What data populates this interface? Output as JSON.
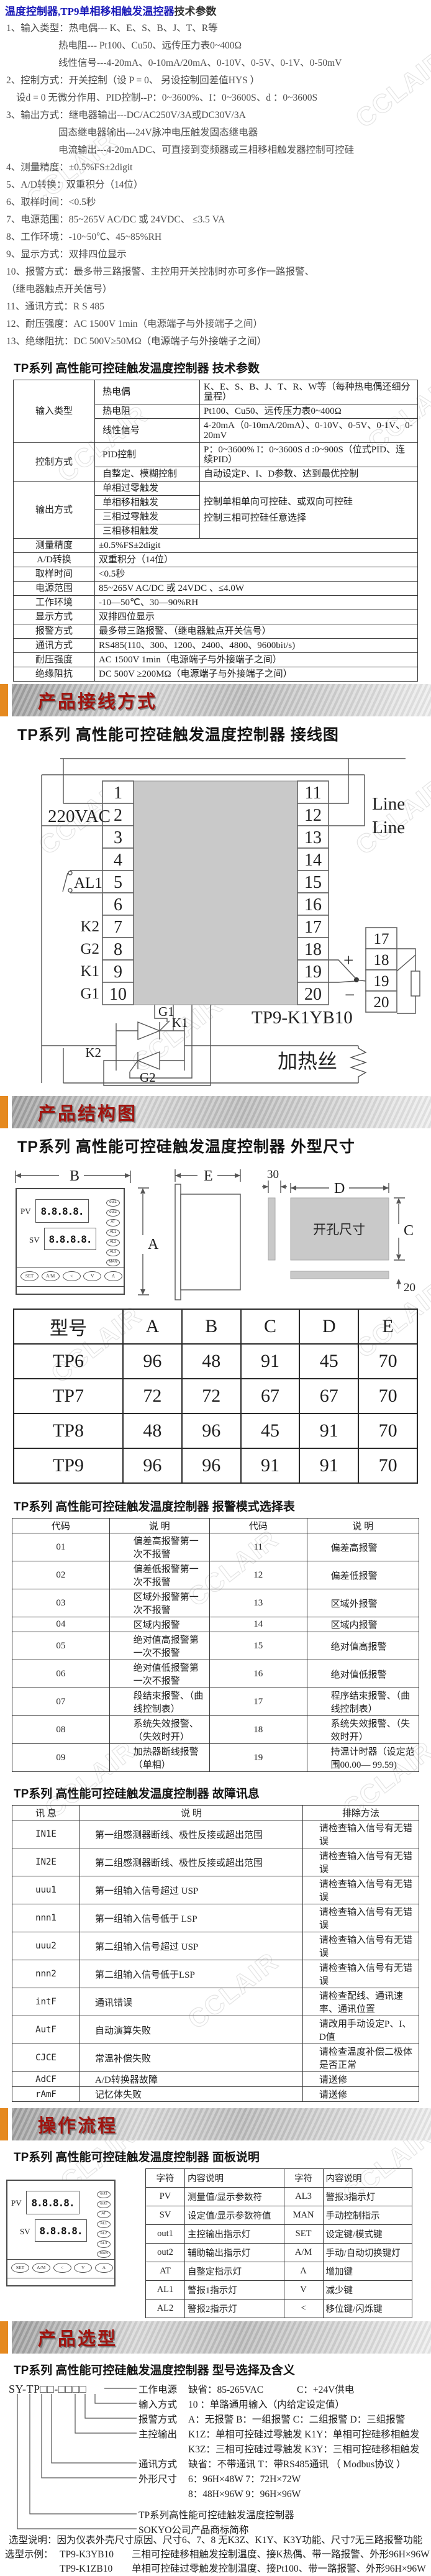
{
  "watermark": "CCLAIR",
  "intro": {
    "title_blue": "温度控制器,TP9单相移相触发温控器",
    "title_black": "技术参数",
    "lines": [
      {
        "indent": 0,
        "text": "1、输入类型：热电偶--- K、E、S、B、J、T、R等"
      },
      {
        "indent": 1,
        "text": "热电阻--- Pt100、Cu50、远传压力表0~400Ω"
      },
      {
        "indent": 1,
        "text": "线性信号---4-20mA、0-10mA/20mA、0-10V、0-5V、0-1V、0-50mV"
      },
      {
        "indent": 0,
        "text": "2、控制方式：开关控制（设 P = 0、 另设控制回差值HYS ）"
      },
      {
        "indent": 2,
        "text": "设d = 0  无微分作用、PID控制--P：0~3600%、I：0~3600S、d ：0~3600S"
      },
      {
        "indent": 0,
        "text": "3、输出方式：继电器输出---DC/AC250V/3A或DC30V/3A"
      },
      {
        "indent": 1,
        "text": "固态继电器输出---24V脉冲电压触发固态继电器"
      },
      {
        "indent": 1,
        "text": "电流输出---4-20mADC、可直接到变频器或三相移相触发器控制可控硅"
      },
      {
        "indent": 0,
        "text": "4、测量精度：±0.5%FS±2digit"
      },
      {
        "indent": 0,
        "text": "5、A/D转换：双重积分（14位）"
      },
      {
        "indent": 0,
        "text": "6、取样时间：<0.5秒"
      },
      {
        "indent": 0,
        "text": "7、电源范围：85~265V  AC/DC 或  24VDC、  ≤3.5 VA"
      },
      {
        "indent": 0,
        "text": "8、工作环境：-10~50℃、45~85%RH"
      },
      {
        "indent": 0,
        "text": "9、显示方式：双排四位显示"
      },
      {
        "indent": 0,
        "text": "10、报警方式：最多带三路报警、主控用开关控制时亦可多作一路报警、"
      },
      {
        "indent": 0,
        "text": "（继电器触点开关信号）"
      },
      {
        "indent": 0,
        "text": "11、通讯方式：R S 485"
      },
      {
        "indent": 0,
        "text": "12、耐压强度：AC 1500V 1min（电源端子与外接端子之间）"
      },
      {
        "indent": 0,
        "text": "13、绝缘阻抗：DC  500V≥50MΩ（电源端子与外接端子之间）"
      }
    ]
  },
  "spec": {
    "title": "TP系列 高性能可控硅触发温度控制器 技术参数",
    "rows": [
      [
        {
          "t": "输入类型",
          "rs": 3,
          "cls": "c1"
        },
        {
          "t": "热电偶",
          "cls": "c2"
        },
        {
          "t": "K、E、S、B、J、T、R、W等（每种热电偶还细分量程）"
        }
      ],
      [
        {
          "t": "热电阻",
          "cls": "c2"
        },
        {
          "t": "Pt100、Cu50、远传压力表0~400Ω"
        }
      ],
      [
        {
          "t": "线性信号",
          "cls": "c2"
        },
        {
          "t": "4-20mA（0-10mA/20mA）、0-10V、0-5V、0-1V、0-20mV"
        }
      ],
      [
        {
          "t": "控制方式",
          "rs": 2,
          "cls": "c1"
        },
        {
          "t": "PID控制",
          "cls": "c2"
        },
        {
          "t": "P：0~3600%  I：0~3600S d :0~900S（位式PID、连续PID）"
        }
      ],
      [
        {
          "t": "自整定、模糊控制",
          "cls": "c2"
        },
        {
          "t": "自动设定P、I、D参数、达到最优控制"
        }
      ],
      [
        {
          "t": "输出方式",
          "rs": 4,
          "cls": "c1"
        },
        {
          "t": "单相过零触发",
          "cls": "c2"
        },
        {
          "t": "控制单相单向可控硅、或双向可控硅\n控制三相可控硅任意选择",
          "rs": 4,
          "cls": "pre"
        }
      ],
      [
        {
          "t": "单相移相触发",
          "cls": "c2"
        }
      ],
      [
        {
          "t": "三相过零触发",
          "cls": "c2"
        }
      ],
      [
        {
          "t": "三相移相触发",
          "cls": "c2"
        }
      ],
      [
        {
          "t": "测量精度",
          "cls": "c1"
        },
        {
          "t": "±0.5%FS±2digit",
          "cs": 2
        }
      ],
      [
        {
          "t": "A/D转换",
          "cls": "c1"
        },
        {
          "t": "双重积分（14位）",
          "cs": 2
        }
      ],
      [
        {
          "t": "取样时间",
          "cls": "c1"
        },
        {
          "t": "<0.5秒",
          "cs": 2
        }
      ],
      [
        {
          "t": "电源范围",
          "cls": "c1"
        },
        {
          "t": "85~265V  AC/DC 或 24VDC 、≤4.0W",
          "cs": 2
        }
      ],
      [
        {
          "t": "工作环境",
          "cls": "c1"
        },
        {
          "t": "-10—50℃、30—90%RH",
          "cs": 2
        }
      ],
      [
        {
          "t": "显示方式",
          "cls": "c1"
        },
        {
          "t": "双排四位显示",
          "cs": 2
        }
      ],
      [
        {
          "t": "报警方式",
          "cls": "c1"
        },
        {
          "t": "最多带三路报警、（继电器触点开关信号）",
          "cs": 2
        }
      ],
      [
        {
          "t": "通讯方式",
          "cls": "c1"
        },
        {
          "t": "RS485(110、300、1200、2400、4800、9600bit/s)",
          "cs": 2
        }
      ],
      [
        {
          "t": "耐压强度",
          "cls": "c1"
        },
        {
          "t": "AC 1500V  1min（电源端子与外接端子之间）",
          "cs": 2
        }
      ],
      [
        {
          "t": "绝缘阻抗",
          "cls": "c1"
        },
        {
          "t": "DC 500V  ≥200MΩ（电源端子与外接端子之间）",
          "cs": 2
        }
      ]
    ]
  },
  "banners": {
    "wiring": "产品接线方式",
    "structure": "产品结构图",
    "operation": "操作流程",
    "selection": "产品选型"
  },
  "wiring": {
    "title": "TP系列 高性能可控硅触发温度控制器 接线图",
    "voltage": "220VAC",
    "al1": "AL1",
    "k2": "K2",
    "g2": "G2",
    "k1": "K1",
    "g1": "G1",
    "line1": "Line",
    "line2": "Line",
    "plus": "+",
    "minus": "−",
    "g1_scr": "G1",
    "k1_scr": "K1",
    "k2_scr": "K2",
    "g2_scr": "G2",
    "model": "TP9-K1YB10",
    "heater": "加热丝",
    "left_terminals": [
      "1",
      "2",
      "3",
      "4",
      "5",
      "6",
      "7",
      "8",
      "9",
      "10"
    ],
    "right_terminals": [
      "11",
      "12",
      "13",
      "14",
      "15",
      "16",
      "17",
      "18",
      "19",
      "20"
    ],
    "sensor_terminals": [
      "17",
      "18",
      "19",
      "20"
    ]
  },
  "structure": {
    "title": "TP系列 高性能可控硅触发温度控制器 外型尺寸",
    "dims": {
      "A": "A",
      "B": "B",
      "C": "C",
      "D": "D",
      "E": "E",
      "d30": "30",
      "d20": "20",
      "cutout": "开孔尺寸"
    }
  },
  "panel": {
    "pv": "PV",
    "sv": "SV",
    "digits": "8.8.8.8.",
    "indicators": [
      "out1",
      "out2",
      "AT",
      "AL1",
      "AL2",
      "AL3",
      "MAN"
    ],
    "buttons": [
      "SET",
      "A/M",
      "<",
      "V",
      "Λ"
    ]
  },
  "dim_table": {
    "rows": [
      [
        "型号",
        "A",
        "B",
        "C",
        "D",
        "E"
      ],
      [
        "TP6",
        "96",
        "48",
        "91",
        "45",
        "70"
      ],
      [
        "TP7",
        "72",
        "72",
        "67",
        "67",
        "70"
      ],
      [
        "TP8",
        "48",
        "96",
        "45",
        "91",
        "70"
      ],
      [
        "TP9",
        "96",
        "96",
        "91",
        "91",
        "70"
      ]
    ]
  },
  "alarm": {
    "title": "TP系列 高性能可控硅触发温度控制器 报警模式选择表",
    "rows": [
      [
        {
          "t": "代码",
          "cls": "ctr"
        },
        {
          "t": "说    明",
          "cls": "ctr"
        },
        {
          "t": "代码",
          "cls": "ctr"
        },
        {
          "t": "说    明",
          "cls": "ctr"
        }
      ],
      [
        {
          "t": "01",
          "cls": "ctr"
        },
        {
          "t": "偏差高报警第一次不报警",
          "cls": "dsc"
        },
        {
          "t": "11",
          "cls": "ctr"
        },
        {
          "t": "偏差高报警",
          "cls": "dsc"
        }
      ],
      [
        {
          "t": "02",
          "cls": "ctr"
        },
        {
          "t": "偏差低报警第一次不报警",
          "cls": "dsc"
        },
        {
          "t": "12",
          "cls": "ctr"
        },
        {
          "t": "偏差低报警",
          "cls": "dsc"
        }
      ],
      [
        {
          "t": "03",
          "cls": "ctr"
        },
        {
          "t": "区域外报警第一次不报警",
          "cls": "dsc"
        },
        {
          "t": "13",
          "cls": "ctr"
        },
        {
          "t": "区域外报警",
          "cls": "dsc"
        }
      ],
      [
        {
          "t": "04",
          "cls": "ctr"
        },
        {
          "t": "区域内报警",
          "cls": "dsc"
        },
        {
          "t": "14",
          "cls": "ctr"
        },
        {
          "t": "区域内报警",
          "cls": "dsc"
        }
      ],
      [
        {
          "t": "05",
          "cls": "ctr"
        },
        {
          "t": "绝对值高报警第一次不报警",
          "cls": "dsc"
        },
        {
          "t": "15",
          "cls": "ctr"
        },
        {
          "t": "绝对值高报警",
          "cls": "dsc"
        }
      ],
      [
        {
          "t": "06",
          "cls": "ctr"
        },
        {
          "t": "绝对值低报警第一次不报警",
          "cls": "dsc"
        },
        {
          "t": "16",
          "cls": "ctr"
        },
        {
          "t": "绝对值低报警",
          "cls": "dsc"
        }
      ],
      [
        {
          "t": "07",
          "cls": "ctr"
        },
        {
          "t": "段结束报警、（曲线控制表）",
          "cls": "dsc"
        },
        {
          "t": "17",
          "cls": "ctr"
        },
        {
          "t": "程序结束报警、（曲线控制表）",
          "cls": "dsc"
        }
      ],
      [
        {
          "t": "08",
          "cls": "ctr"
        },
        {
          "t": "系统失效报警、（失效时开）",
          "cls": "dsc"
        },
        {
          "t": "18",
          "cls": "ctr"
        },
        {
          "t": "系统失效报警、（失效时开）",
          "cls": "dsc"
        }
      ],
      [
        {
          "t": "09",
          "cls": "ctr"
        },
        {
          "t": "加热器断线报警（单相）",
          "cls": "dsc"
        },
        {
          "t": "19",
          "cls": "ctr"
        },
        {
          "t": "持温计时器（设定范围00.00— 99.59)",
          "cls": "dsc"
        }
      ]
    ]
  },
  "fault": {
    "title": "TP系列 高性能可控硅触发温度控制器 故障讯息",
    "rows": [
      [
        {
          "t": "讯  息",
          "cls": "ctr"
        },
        {
          "t": "说  明",
          "cls": "ctr"
        },
        {
          "t": "排除方法",
          "cls": "ctr"
        }
      ],
      [
        {
          "t": "IN1E",
          "cls": "code"
        },
        {
          "t": "第一组感测器断线、极性反接或超出范围",
          "cls": "dsc"
        },
        {
          "t": "请检查输入信号有无错误",
          "cls": "dsc2"
        }
      ],
      [
        {
          "t": "IN2E",
          "cls": "code"
        },
        {
          "t": "第二组感测器断线、极性反接或超出范围",
          "cls": "dsc"
        },
        {
          "t": "请检查输入信号有无错误",
          "cls": "dsc2"
        }
      ],
      [
        {
          "t": "uuu1",
          "cls": "code"
        },
        {
          "t": "第一组输入信号超过 USP",
          "cls": "dsc"
        },
        {
          "t": "请检查输入信号有无错误",
          "cls": "dsc2"
        }
      ],
      [
        {
          "t": "nnn1",
          "cls": "code"
        },
        {
          "t": "第一组输入信号低于 LSP",
          "cls": "dsc"
        },
        {
          "t": "请检查输入信号有无错误",
          "cls": "dsc2"
        }
      ],
      [
        {
          "t": "uuu2",
          "cls": "code"
        },
        {
          "t": "第二组输入信号超过 USP",
          "cls": "dsc"
        },
        {
          "t": "请检查输入信号有无错误",
          "cls": "dsc2"
        }
      ],
      [
        {
          "t": "nnn2",
          "cls": "code"
        },
        {
          "t": "第二组输入信号低于LSP",
          "cls": "dsc"
        },
        {
          "t": "请检查输入信号有无错误",
          "cls": "dsc2"
        }
      ],
      [
        {
          "t": "intF",
          "cls": "code"
        },
        {
          "t": "通讯错误",
          "cls": "dsc"
        },
        {
          "t": "请检查配线、通讯速率、通讯位置",
          "cls": "dsc2"
        }
      ],
      [
        {
          "t": "AutF",
          "cls": "code"
        },
        {
          "t": "自动演算失败",
          "cls": "dsc"
        },
        {
          "t": "请改用手动设定P、I、D值",
          "cls": "dsc2"
        }
      ],
      [
        {
          "t": "CJCE",
          "cls": "code"
        },
        {
          "t": "常温补偿失败",
          "cls": "dsc"
        },
        {
          "t": "请检查温度补偿二极体是否正常",
          "cls": "dsc2"
        }
      ],
      [
        {
          "t": "AdCF",
          "cls": "code"
        },
        {
          "t": "A/D转换器故障",
          "cls": "dsc"
        },
        {
          "t": "请送修",
          "cls": "dsc2"
        }
      ],
      [
        {
          "t": "rAmF",
          "cls": "code"
        },
        {
          "t": "记忆体失败",
          "cls": "dsc"
        },
        {
          "t": "请送修",
          "cls": "dsc2"
        }
      ]
    ]
  },
  "operation": {
    "title": "TP系列 高性能可控硅触发温度控制器 面板说明",
    "rows": [
      [
        {
          "t": "字符",
          "cls": "ctr"
        },
        {
          "t": "内容说明"
        },
        {
          "t": "字符",
          "cls": "ctr"
        },
        {
          "t": "内容说明"
        }
      ],
      [
        {
          "t": "PV",
          "cls": "ctr"
        },
        {
          "t": "测量值/显示参数符"
        },
        {
          "t": "AL3",
          "cls": "ctr"
        },
        {
          "t": "警报3指示灯"
        }
      ],
      [
        {
          "t": "SV",
          "cls": "ctr"
        },
        {
          "t": "设定值/显示参数符值"
        },
        {
          "t": "MAN",
          "cls": "ctr"
        },
        {
          "t": "手动控制指示"
        }
      ],
      [
        {
          "t": "out1",
          "cls": "ctr"
        },
        {
          "t": "主控输出指示灯"
        },
        {
          "t": "SET",
          "cls": "ctr"
        },
        {
          "t": "设定键/模式键"
        }
      ],
      [
        {
          "t": "out2",
          "cls": "ctr"
        },
        {
          "t": "辅助输出指示灯"
        },
        {
          "t": "A/M",
          "cls": "ctr"
        },
        {
          "t": "手动/自动切换键灯"
        }
      ],
      [
        {
          "t": "AT",
          "cls": "ctr"
        },
        {
          "t": "自整定指示灯"
        },
        {
          "t": "Λ",
          "cls": "ctr"
        },
        {
          "t": "增加键"
        }
      ],
      [
        {
          "t": "AL1",
          "cls": "ctr"
        },
        {
          "t": "警报1指示灯"
        },
        {
          "t": "V",
          "cls": "ctr"
        },
        {
          "t": "减少键"
        }
      ],
      [
        {
          "t": "AL2",
          "cls": "ctr"
        },
        {
          "t": "警报2指示灯"
        },
        {
          "t": "<",
          "cls": "ctr"
        },
        {
          "t": "移位键/闪烁键"
        }
      ]
    ]
  },
  "selection": {
    "title": "TP系列 高性能可控硅触发温度控制器 型号选择及含义",
    "code": "SY-TP□□-□□□□",
    "rows": [
      {
        "label": "工作电源",
        "text": "缺省：85-265VAC",
        "text2": "C：+24V供电",
        "cls": ""
      },
      {
        "label": "输入方式",
        "text": "10 ：单路通用输入（内给定设定值）",
        "text2": "",
        "cls": ""
      },
      {
        "label": "报警方式",
        "text": "A：无报警      B：一组报警      C：二组报警      D：三组报警",
        "text2": "",
        "cls": ""
      },
      {
        "label": "主控输出",
        "text": "K1Z：单相可控硅过零触发      K1Y：单相可控硅移相触发",
        "text2": "",
        "cls": ""
      },
      {
        "label": "",
        "text": "K3Z：三相可控硅过零触发      K3Y：三相可控硅移相触发",
        "text2": "",
        "cls": ""
      },
      {
        "label": "通讯方式",
        "text": "缺省：不带通讯              T：带RS485通讯 （ Modbus协议 ）",
        "text2": "",
        "cls": ""
      },
      {
        "label": "外形尺寸",
        "text": "6：96H×48W              7：72H×72W",
        "text2": "",
        "cls": ""
      },
      {
        "label": "",
        "text": "8：48H×96W              9：96H×96W",
        "text2": "",
        "cls": ""
      },
      {
        "label": "",
        "text": "TP系列高性能可控硅触发温度控制器",
        "text2": "",
        "cls": "desc"
      },
      {
        "label": "",
        "text": "SOKYO公司产品商标简称",
        "text2": "",
        "cls": "desc"
      }
    ],
    "note": "选型说明：因为仪表外壳尺寸原因、尺寸6、7、8 无K3Z、K1Y、K3Y功能、尺寸7无三路报警功能",
    "example_label": "选型示例：",
    "examples": [
      {
        "model": "TP9-K3YB10",
        "desc": "三相可控硅移相触发控制温度、接K热偶、带一路报警、外形96H×96W"
      },
      {
        "model": "TP9-K1ZB10",
        "desc": "单相可控硅过零触发控制温度、接Pt100、带一路报警、外形96H×96W"
      }
    ]
  }
}
